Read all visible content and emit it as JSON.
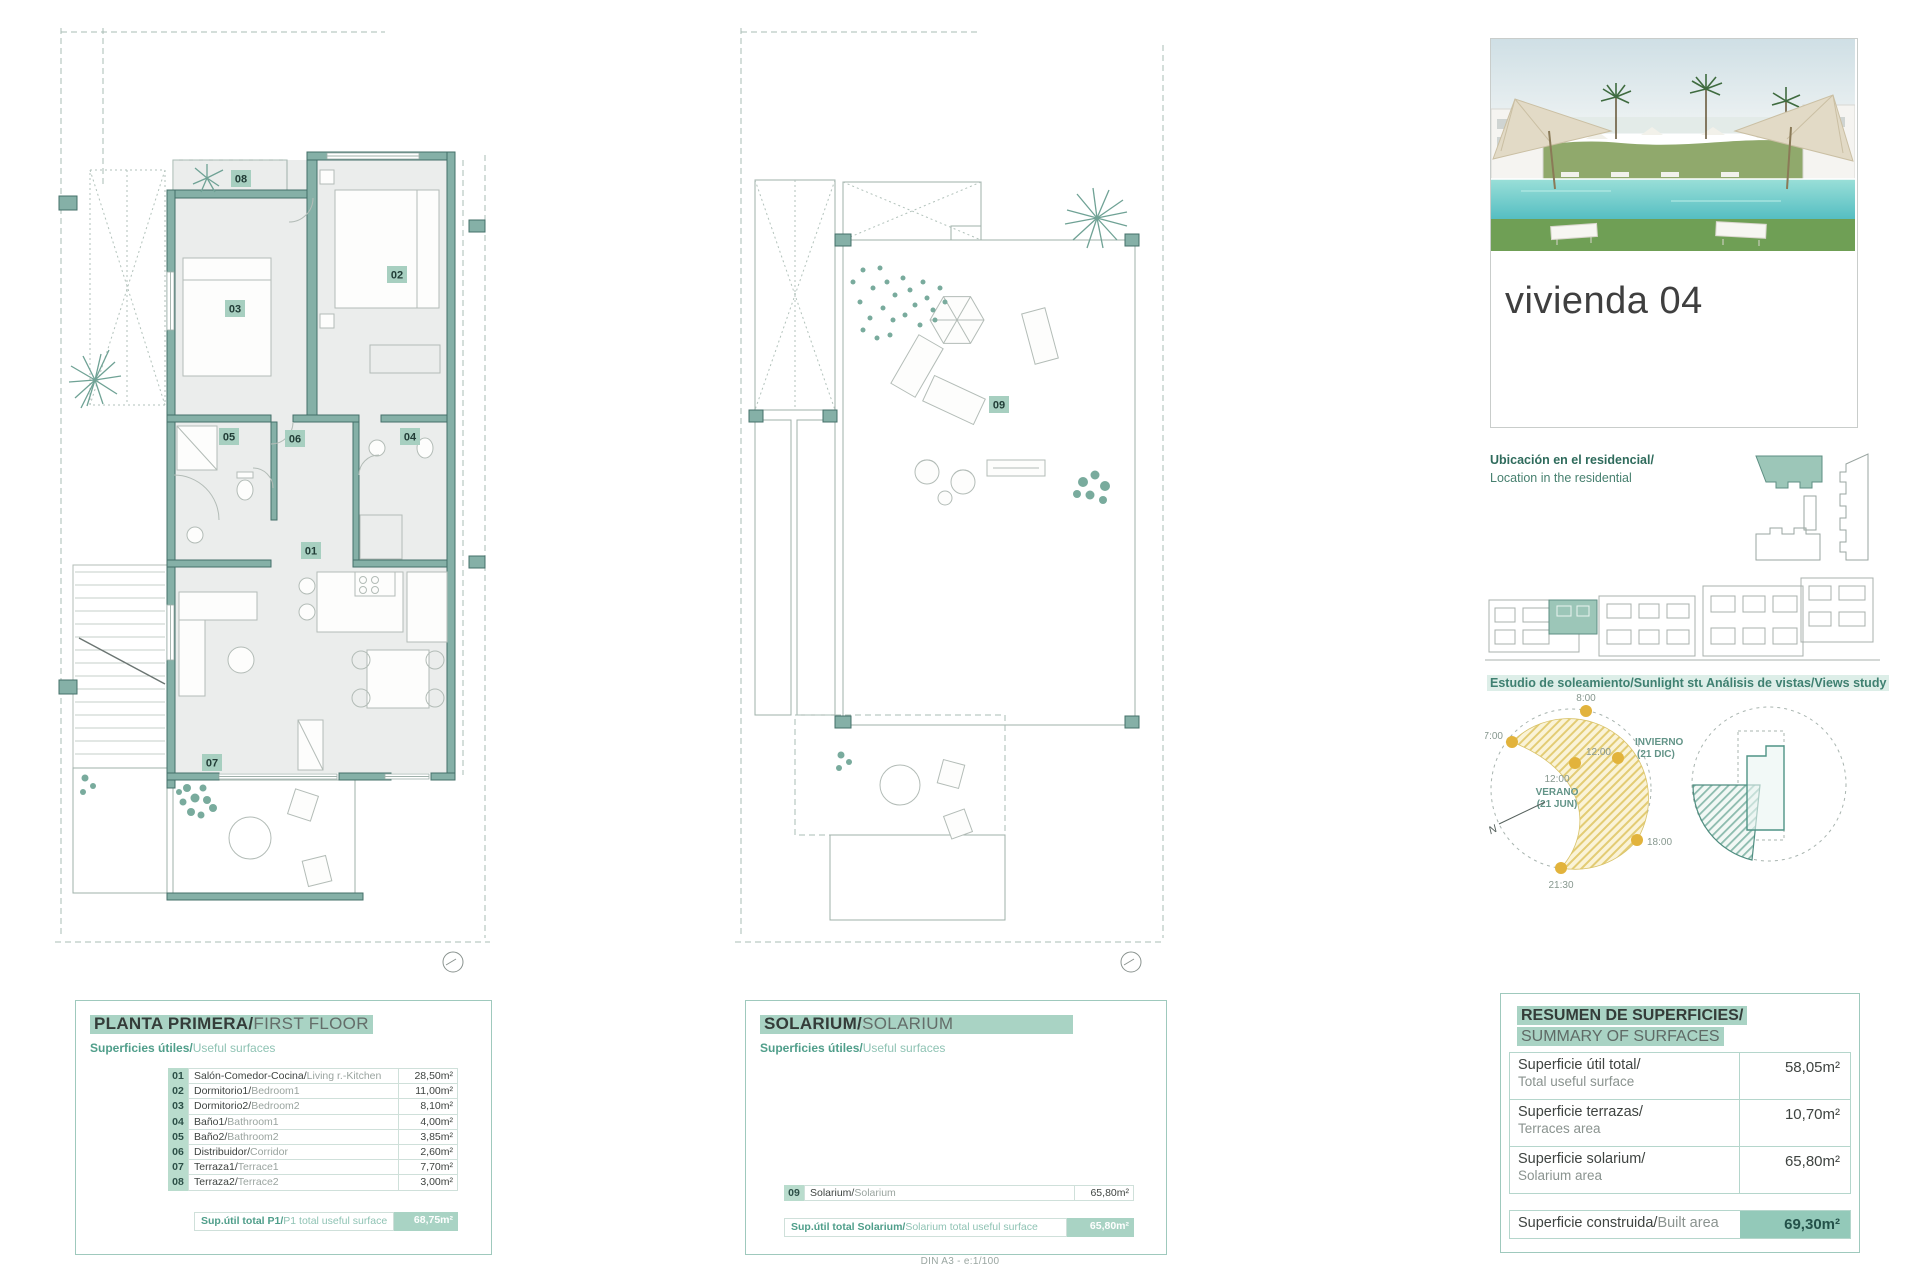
{
  "colors": {
    "accent_highlight": "#a9d3c4",
    "box_border": "#9fc9bd",
    "wall_teal": "#85b0a7",
    "badge_bg": "#a7cfc0",
    "sun_yellow": "#e2b33c",
    "teal_text": "#4f9e8a",
    "built_value_bg": "#93c9b9"
  },
  "left_panel": {
    "title_es": "PLANTA PRIMERA/",
    "title_en": "FIRST FLOOR",
    "subtitle_es": "Superficies útiles/",
    "subtitle_en": "Useful surfaces",
    "rows": [
      {
        "num": "01",
        "name_es": "Salón-Comedor-Cocina/",
        "name_en": "Living r.-Kitchen",
        "value": "28,50m²"
      },
      {
        "num": "02",
        "name_es": "Dormitorio1/",
        "name_en": "Bedroom1",
        "value": "11,00m²"
      },
      {
        "num": "03",
        "name_es": "Dormitorio2/",
        "name_en": "Bedroom2",
        "value": "8,10m²"
      },
      {
        "num": "04",
        "name_es": "Baño1/",
        "name_en": "Bathroom1",
        "value": "4,00m²"
      },
      {
        "num": "05",
        "name_es": "Baño2/",
        "name_en": "Bathroom2",
        "value": "3,85m²"
      },
      {
        "num": "06",
        "name_es": "Distribuidor/",
        "name_en": "Corridor",
        "value": "2,60m²"
      },
      {
        "num": "07",
        "name_es": "Terraza1/",
        "name_en": "Terrace1",
        "value": "7,70m²"
      },
      {
        "num": "08",
        "name_es": "Terraza2/",
        "name_en": "Terrace2",
        "value": "3,00m²"
      }
    ],
    "total_label_es": "Sup.útil total P1/",
    "total_label_en": "P1 total useful surface",
    "total_value": "68,75m²"
  },
  "middle_panel": {
    "title_es": "SOLARIUM/",
    "title_en": "SOLARIUM",
    "subtitle_es": "Superficies útiles/",
    "subtitle_en": "Useful surfaces",
    "rows": [
      {
        "num": "09",
        "name_es": "Solarium/",
        "name_en": "Solarium",
        "value": "65,80m²"
      }
    ],
    "total_label_es": "Sup.útil total Solarium/",
    "total_label_en": "Solarium total useful surface",
    "total_value": "65,80m²"
  },
  "right_panel": {
    "unit_title": "vivienda 04",
    "location_line1": "Ubicación en el residencial/",
    "location_line2": "Location in the residential",
    "sunlight_label": "Estudio de soleamiento/Sunlight study",
    "views_label": "Análisis de vistas/Views study",
    "sun_diagram": {
      "t8": "8:00",
      "t7": "7:00",
      "t12_summer": "12:00",
      "t12_winter": "12:00",
      "t18": "18:00",
      "t2130": "21:30",
      "summer_line1": "VERANO",
      "summer_line2": "(21 JUN)",
      "winter_line1": "INVIERNO",
      "winter_line2": "(21 DIC)",
      "north": "N"
    },
    "summary": {
      "title_es": "RESUMEN DE SUPERFICIES/",
      "title_en": "SUMMARY OF SURFACES",
      "rows": [
        {
          "label_es": "Superficie útil total/",
          "label_en": "Total useful surface",
          "value": "58,05m²"
        },
        {
          "label_es": "Superficie terrazas/",
          "label_en": "Terraces area",
          "value": "10,70m²"
        },
        {
          "label_es": "Superficie solarium/",
          "label_en": "Solarium area",
          "value": "65,80m²"
        }
      ],
      "built_label_es": "Superficie construida/",
      "built_label_en": "Built area",
      "built_value": "69,30m²"
    }
  },
  "footer": {
    "scale_note": "DIN A3 - e:1/100"
  }
}
